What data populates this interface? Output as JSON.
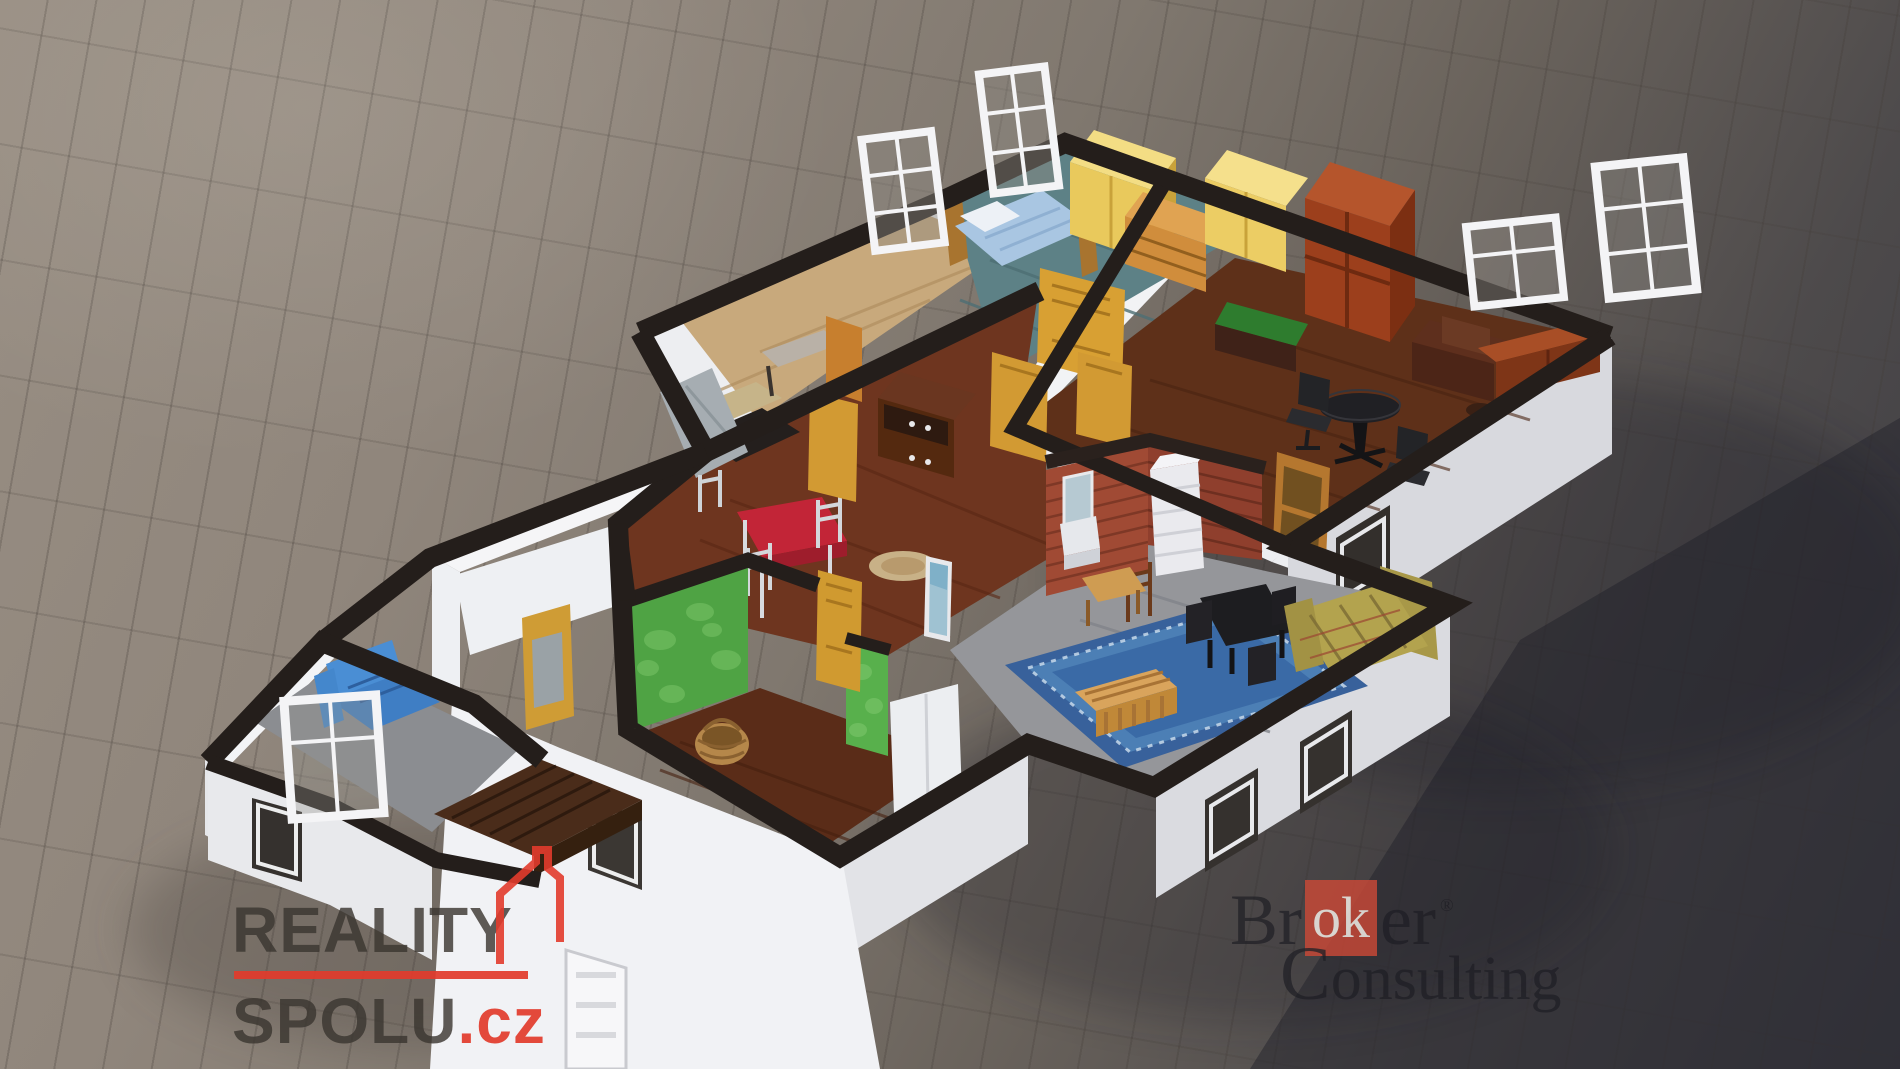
{
  "watermarks": {
    "reality_spolu": {
      "line1": "REALITY",
      "line2": "SPOLU",
      "tld": ".cz",
      "accent_color": "#e23b2c",
      "text_color": "#3a3530"
    },
    "broker_consulting": {
      "part1": "Br",
      "part2": "ok",
      "part3": "er",
      "registered": "®",
      "line2_cap": "C",
      "line2_rest": "onsulting",
      "box_color": "#cb4936",
      "text_color": "#1c1c22"
    }
  },
  "scene": {
    "type": "3d-floorplan-render",
    "description": "Isometric cutaway 3D render of an apartment floor plan standing on grey tiled ground with a large cast shadow to the right",
    "ground_color": "#90867c",
    "shadow_color": "#23232b",
    "wall_color": "#edeef1",
    "wall_top_color": "#241e1b",
    "rooms": [
      {
        "name": "storage-room",
        "floor_color": "#c8a97c"
      },
      {
        "name": "bedroom",
        "floor_color": "#5d8186"
      },
      {
        "name": "office",
        "floor_color": "#5e3019"
      },
      {
        "name": "hallway-dining",
        "floor_color": "#6e351f"
      },
      {
        "name": "bathroom",
        "floor_color": "#8b8c90",
        "wall_color": "#a04a34"
      },
      {
        "name": "living-room",
        "floor_color": "#95969a",
        "rug_color": "#38619b"
      },
      {
        "name": "green-room",
        "floor_color": "#5a2c18",
        "wall_color": "#4fa344"
      },
      {
        "name": "balcony",
        "floor_color": "#8b8d91"
      }
    ],
    "furniture": [
      "bed",
      "yellow-wardrobes",
      "dresser",
      "tall-bookcase",
      "writing-desk",
      "round-black-table",
      "office-chairs",
      "sideboard",
      "display-cabinet",
      "red-dining-table",
      "white-chairs",
      "round-rug",
      "standing-mirror",
      "brick-wall",
      "tiled-stove",
      "wash-basin",
      "blue-ornate-rug",
      "black-dining-table",
      "plaid-sofa",
      "wooden-chair",
      "slat-bench",
      "wicker-basket",
      "white-cabinet",
      "blue-sofa",
      "wooden-bench",
      "leaning-mattress",
      "staircase",
      "window-frames",
      "honey-doors"
    ]
  }
}
